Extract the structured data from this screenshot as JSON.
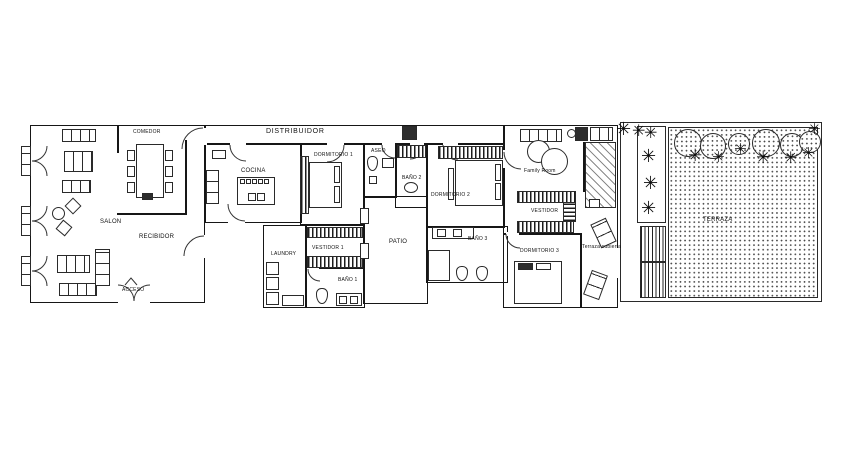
{
  "plan": {
    "labels": {
      "comedor": "COMEDOR",
      "distribuidor": "DISTRIBUIDOR",
      "salon": "SALON",
      "recibidor": "RECIBIDOR",
      "acceso": "ACCESO",
      "cocina": "COCINA",
      "dormitorio1": "DORMITORIO 1",
      "laundry": "LAUNDRY",
      "vestidor1": "VESTIDOR 1",
      "bano1": "BAÑO 1",
      "aseo": "ASEO",
      "bano2": "BAÑO 2",
      "patio": "PATIO",
      "dormitorio2": "DORMITORIO 2",
      "bano3": "BAÑO 3",
      "family_room": "Family Room",
      "vestidor": "VESTIDOR",
      "dormitorio3": "DORMITORIO 3",
      "terraza_cubierta": "Terraza cubierta",
      "terraza": "TERRAZA"
    },
    "icons": {
      "palm": "✳"
    },
    "colors": {
      "line": "#161616",
      "background": "#ffffff"
    }
  }
}
